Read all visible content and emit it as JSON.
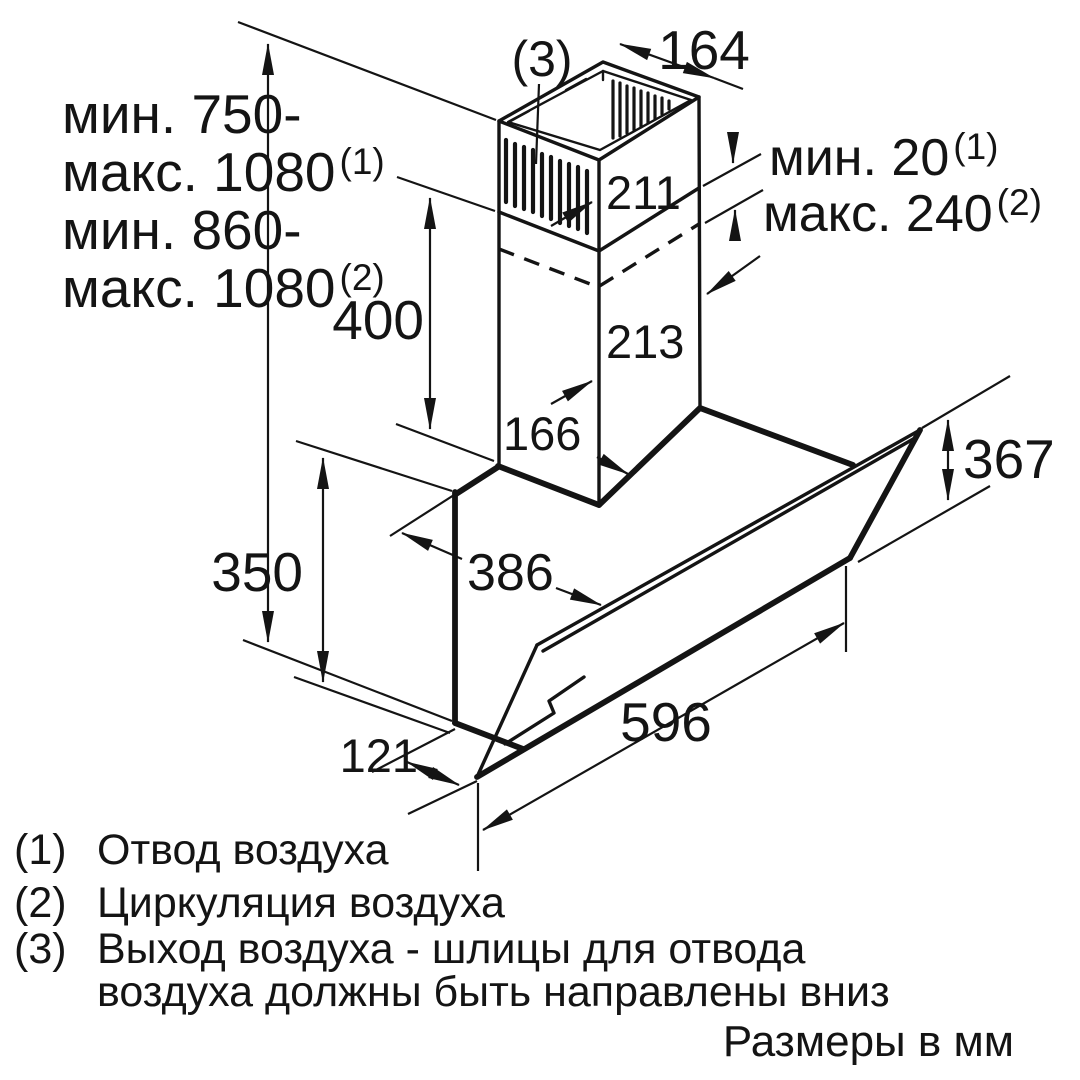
{
  "colors": {
    "line": "#141414",
    "background": "#ffffff"
  },
  "wall_distance_note": {
    "line1": "мин. 750-",
    "line2": "макс. 1080",
    "line2_sup": "(1)",
    "line3": "мин. 860-",
    "line4": "макс. 1080",
    "line4_sup": "(2)"
  },
  "telescopic_note": {
    "min": "мин. 20",
    "min_sup": "(1)",
    "max": "макс. 240",
    "max_sup": "(2)"
  },
  "callout_3": "(3)",
  "dimensions": {
    "chimney_top_depth": "164",
    "upper_duct_height": "211",
    "lower_duct_height": "213",
    "duct_width": "166",
    "chimney_height": "400",
    "body_height": "350",
    "top_depth": "386",
    "hood_width": "596",
    "bottom_depth": "121",
    "panel_height": "367"
  },
  "legend": {
    "items": [
      {
        "key": "(1)",
        "text": "Отвод воздуха"
      },
      {
        "key": "(2)",
        "text": "Циркуляция воздуха"
      },
      {
        "key": "(3)",
        "text": "Выход воздуха - шлицы для отвода",
        "text_line2": "воздуха должны быть направлены вниз"
      }
    ],
    "units_note": "Размеры в мм"
  }
}
